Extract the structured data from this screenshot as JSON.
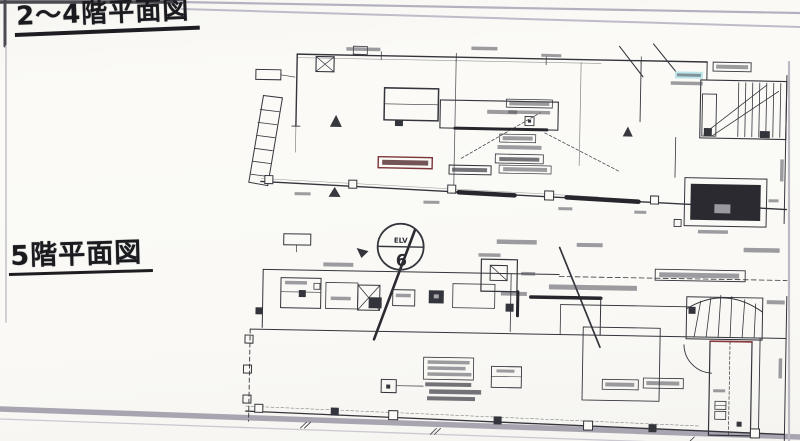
{
  "titles": {
    "upper": "2〜4階平面図",
    "lower": "5階平面図"
  },
  "balloon": {
    "top_label": "ELV",
    "bottom_label": "6"
  },
  "colors": {
    "paper": "#fbfaf7",
    "ink": "#34353c",
    "scan_edge_gray": "#aba7b3",
    "highlight_cyan": "#bfe6ea",
    "accent_red": "#7c3438",
    "elevator_fill": "#2b2a30"
  }
}
